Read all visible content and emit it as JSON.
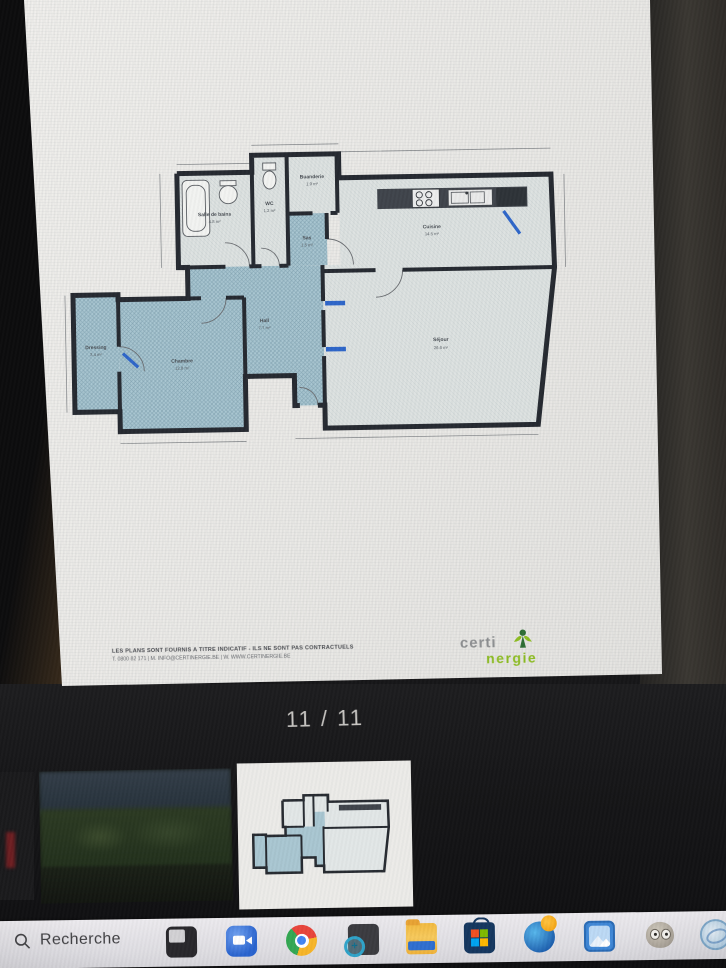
{
  "viewer": {
    "page_indicator": "11 / 11"
  },
  "plan": {
    "rooms": [
      {
        "name": "Salle de bains",
        "area": "4.8 m²"
      },
      {
        "name": "WC",
        "area": "1.2 m²"
      },
      {
        "name": "Buanderie",
        "area": "1.9 m²"
      },
      {
        "name": "Sas",
        "area": "1.5 m²"
      },
      {
        "name": "Cuisine",
        "area": "14.5 m²"
      },
      {
        "name": "Hall",
        "area": "7.7 m²"
      },
      {
        "name": "Dressing",
        "area": "3.4 m²"
      },
      {
        "name": "Chambre",
        "area": "12.8 m²"
      },
      {
        "name": "Séjour",
        "area": "26.6 m²"
      }
    ],
    "footer": {
      "disclaimer_line1": "LES PLANS SONT FOURNIS A TITRE INDICATIF - ILS NE SONT PAS CONTRACTUELS",
      "disclaimer_line2": "T. 0800 82 171 | M. INFO@CERTINERGIE.BE | W. WWW.CERTINERGIE.BE",
      "logo_part1": "certi",
      "logo_part2": "nergie"
    }
  },
  "thumbnails": [
    {
      "name": "photo-partial",
      "selected": false
    },
    {
      "name": "photo-aerial",
      "selected": false
    },
    {
      "name": "floor-plan",
      "selected": true
    }
  ],
  "taskbar": {
    "search_label": "Recherche",
    "icons": [
      "search",
      "dark-window",
      "chat",
      "chrome",
      "zoom-tool",
      "file-explorer",
      "microsoft-store",
      "edge-orb",
      "photos",
      "gimp",
      "partial-app"
    ]
  },
  "colors": {
    "plan_blue": "#a9c6d1",
    "plan_pale": "#dde2e1",
    "wall": "#262a31",
    "accent_blue": "#2e66c9",
    "logo_green": "#8cbc22",
    "taskbar_bg": "#e4e3e7"
  }
}
